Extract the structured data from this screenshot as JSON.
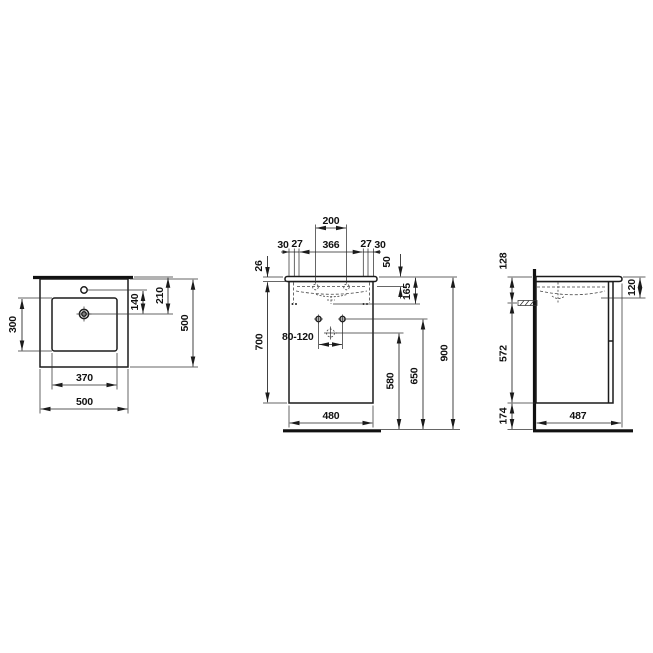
{
  "drawing": {
    "title": "washbasin-with-vanity-unit-dimension-drawing",
    "units": "mm",
    "dims": {
      "top_view": {
        "bowl_depth": "300",
        "tap_to_drain": "140",
        "rear_to_drain": "210",
        "overall_depth": "500",
        "bowl_width": "370",
        "overall_width": "500"
      },
      "front_view": {
        "fixing_centers": "200",
        "side_left": "30",
        "gap_left": "27",
        "inner_width": "366",
        "gap_right": "27",
        "side_right": "30",
        "top_thickness": "26",
        "rim_to_holes": "50",
        "basin_depth": "165",
        "cabinet_height": "700",
        "supply_spacing": "80-120",
        "drain_height": "580",
        "supply_height": "650",
        "overall_height": "900",
        "cabinet_width": "480"
      },
      "side_view": {
        "top_to_trap": "128",
        "bowl_inner_depth": "120",
        "body_height": "572",
        "floor_clearance": "174",
        "depth": "487"
      }
    }
  }
}
